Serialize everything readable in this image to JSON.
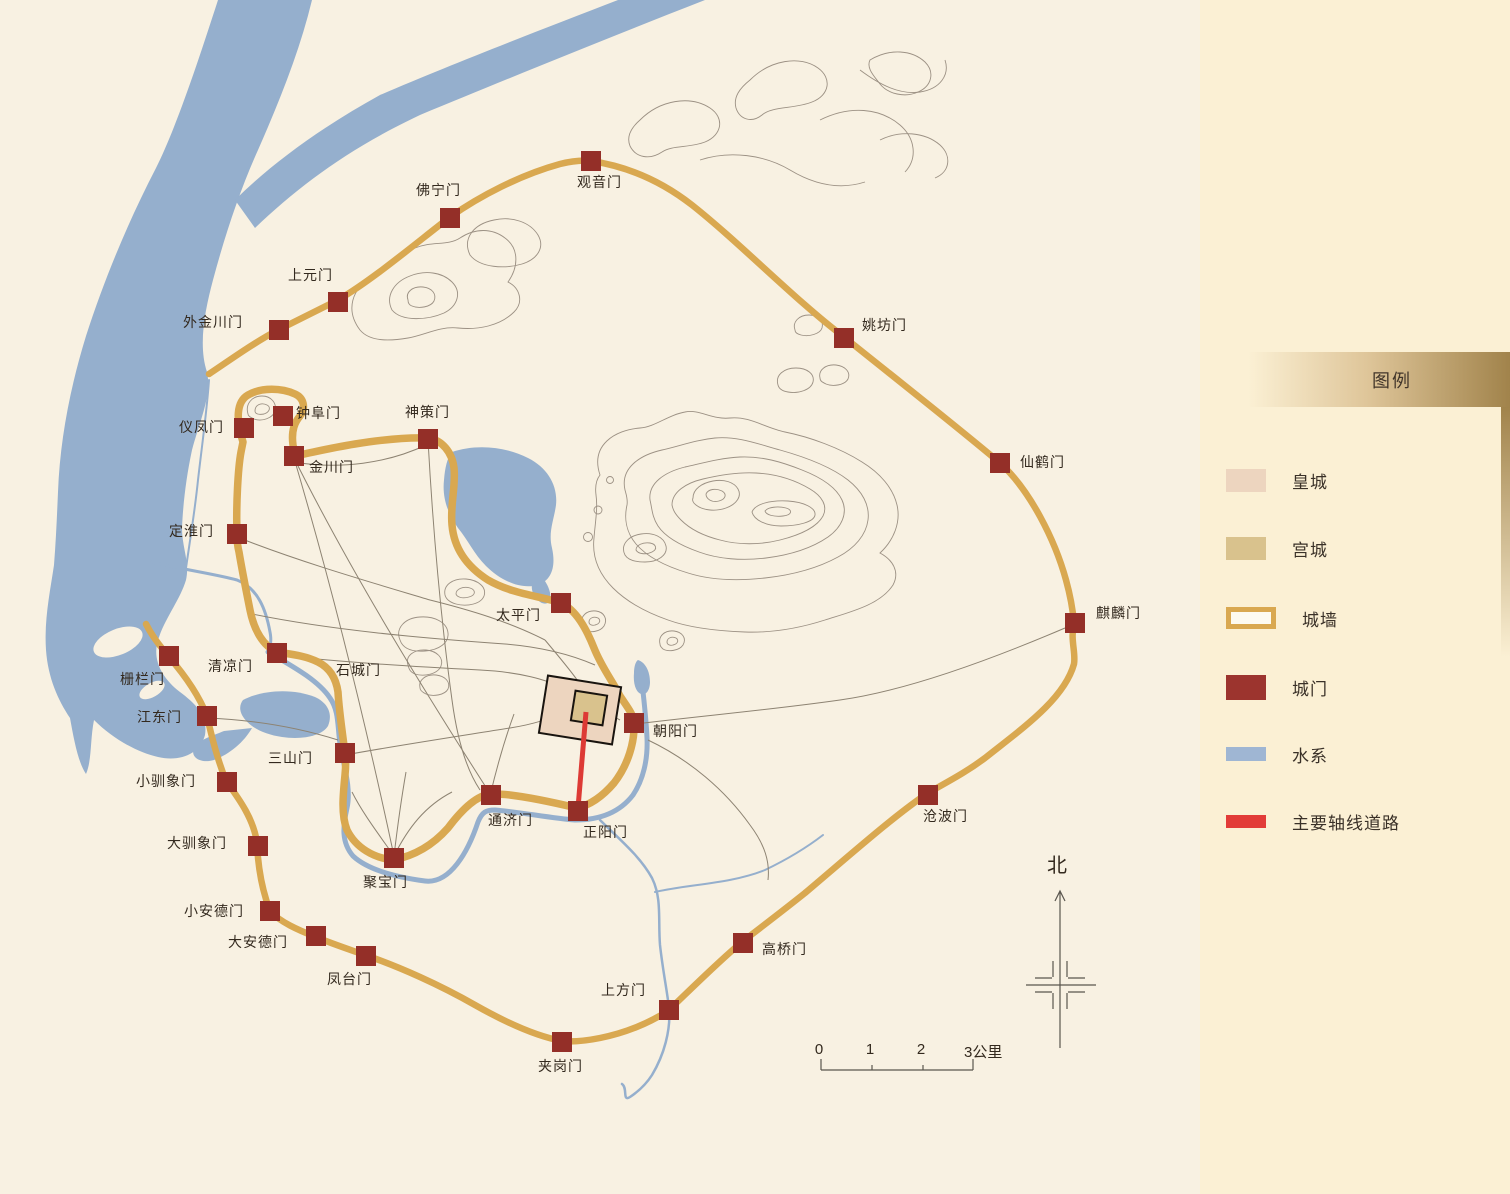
{
  "legend": {
    "title": "图例",
    "items": [
      {
        "label": "皇城",
        "kind": "area",
        "color": "#edd5bf"
      },
      {
        "label": "宫城",
        "kind": "area",
        "color": "#d9c28d"
      },
      {
        "label": "城墙",
        "kind": "wall-outline",
        "color": "#d9a850"
      },
      {
        "label": "城门",
        "kind": "gate",
        "color": "#9c342e"
      },
      {
        "label": "水系",
        "kind": "water",
        "color": "#9fb6d3"
      },
      {
        "label": "主要轴线道路",
        "kind": "axis-road",
        "color": "#e23c38"
      }
    ]
  },
  "compass": {
    "label": "北"
  },
  "scale_bar": {
    "ticks": [
      "0",
      "1",
      "2",
      "3公里"
    ]
  },
  "colors": {
    "map_bg": "#f8f1e2",
    "panel_bg": "#fbf0d4",
    "wall": "#d9a850",
    "gate": "#942f28",
    "water": "#95afcd",
    "axis_road": "#dd3a35",
    "imperial_city": "#edd5bf",
    "palace_city": "#d9c28d",
    "label_text": "#33291e"
  },
  "map": {
    "areas": [
      {
        "name": "皇城"
      },
      {
        "name": "宫城"
      }
    ],
    "gates": [
      {
        "name": "观音门",
        "wall": "outer",
        "x": 591,
        "y": 161,
        "lx": 577,
        "ly": 175,
        "align": "l"
      },
      {
        "name": "佛宁门",
        "wall": "outer",
        "x": 450,
        "y": 218,
        "lx": 461,
        "ly": 183,
        "align": "r"
      },
      {
        "name": "上元门",
        "wall": "outer",
        "x": 338,
        "y": 302,
        "lx": 333,
        "ly": 268,
        "align": "r"
      },
      {
        "name": "外金川门",
        "wall": "outer",
        "x": 279,
        "y": 330,
        "lx": 243,
        "ly": 315,
        "align": "r"
      },
      {
        "name": "姚坊门",
        "wall": "outer",
        "x": 844,
        "y": 338,
        "lx": 862,
        "ly": 318,
        "align": "l"
      },
      {
        "name": "仙鹤门",
        "wall": "outer",
        "x": 1000,
        "y": 463,
        "lx": 1020,
        "ly": 455,
        "align": "l"
      },
      {
        "name": "麒麟门",
        "wall": "outer",
        "x": 1075,
        "y": 623,
        "lx": 1096,
        "ly": 606,
        "align": "l"
      },
      {
        "name": "沧波门",
        "wall": "outer",
        "x": 928,
        "y": 795,
        "lx": 923,
        "ly": 809,
        "align": "l"
      },
      {
        "name": "高桥门",
        "wall": "outer",
        "x": 743,
        "y": 943,
        "lx": 762,
        "ly": 942,
        "align": "l"
      },
      {
        "name": "上方门",
        "wall": "outer",
        "x": 669,
        "y": 1010,
        "lx": 646,
        "ly": 983,
        "align": "r"
      },
      {
        "name": "夹岗门",
        "wall": "outer",
        "x": 562,
        "y": 1042,
        "lx": 538,
        "ly": 1059,
        "align": "l"
      },
      {
        "name": "凤台门",
        "wall": "outer",
        "x": 366,
        "y": 956,
        "lx": 327,
        "ly": 972,
        "align": "l"
      },
      {
        "name": "大安德门",
        "wall": "outer",
        "x": 316,
        "y": 936,
        "lx": 288,
        "ly": 935,
        "align": "r"
      },
      {
        "name": "小安德门",
        "wall": "outer",
        "x": 270,
        "y": 911,
        "lx": 244,
        "ly": 904,
        "align": "r"
      },
      {
        "name": "大驯象门",
        "wall": "outer",
        "x": 258,
        "y": 846,
        "lx": 227,
        "ly": 836,
        "align": "r"
      },
      {
        "name": "小驯象门",
        "wall": "outer",
        "x": 227,
        "y": 782,
        "lx": 196,
        "ly": 774,
        "align": "r"
      },
      {
        "name": "江东门",
        "wall": "outer",
        "x": 207,
        "y": 716,
        "lx": 182,
        "ly": 710,
        "align": "r"
      },
      {
        "name": "栅栏门",
        "wall": "outer",
        "x": 169,
        "y": 656,
        "lx": 165,
        "ly": 672,
        "align": "r"
      },
      {
        "name": "仪凤门",
        "wall": "inner",
        "x": 244,
        "y": 428,
        "lx": 224,
        "ly": 420,
        "align": "r"
      },
      {
        "name": "钟阜门",
        "wall": "inner",
        "x": 283,
        "y": 416,
        "lx": 296,
        "ly": 406,
        "align": "l"
      },
      {
        "name": "金川门",
        "wall": "inner",
        "x": 294,
        "y": 456,
        "lx": 309,
        "ly": 460,
        "align": "l"
      },
      {
        "name": "神策门",
        "wall": "inner",
        "x": 428,
        "y": 439,
        "lx": 405,
        "ly": 405,
        "align": "l"
      },
      {
        "name": "定淮门",
        "wall": "inner",
        "x": 237,
        "y": 534,
        "lx": 214,
        "ly": 524,
        "align": "r"
      },
      {
        "name": "太平门",
        "wall": "inner",
        "x": 561,
        "y": 603,
        "lx": 541,
        "ly": 608,
        "align": "r"
      },
      {
        "name": "清凉门",
        "wall": "inner",
        "x": 277,
        "y": 653,
        "lx": 253,
        "ly": 659,
        "align": "r"
      },
      {
        "name": "石城门",
        "wall": "inner",
        "label_only": true,
        "lx": 336,
        "ly": 663,
        "align": "l"
      },
      {
        "name": "三山门",
        "wall": "inner",
        "x": 345,
        "y": 753,
        "lx": 313,
        "ly": 751,
        "align": "r"
      },
      {
        "name": "朝阳门",
        "wall": "inner",
        "x": 634,
        "y": 723,
        "lx": 653,
        "ly": 724,
        "align": "l"
      },
      {
        "name": "通济门",
        "wall": "inner",
        "x": 491,
        "y": 795,
        "lx": 488,
        "ly": 813,
        "align": "l"
      },
      {
        "name": "正阳门",
        "wall": "inner",
        "x": 578,
        "y": 811,
        "lx": 583,
        "ly": 825,
        "align": "l"
      },
      {
        "name": "聚宝门",
        "wall": "inner",
        "x": 394,
        "y": 858,
        "lx": 363,
        "ly": 875,
        "align": "l"
      }
    ]
  }
}
